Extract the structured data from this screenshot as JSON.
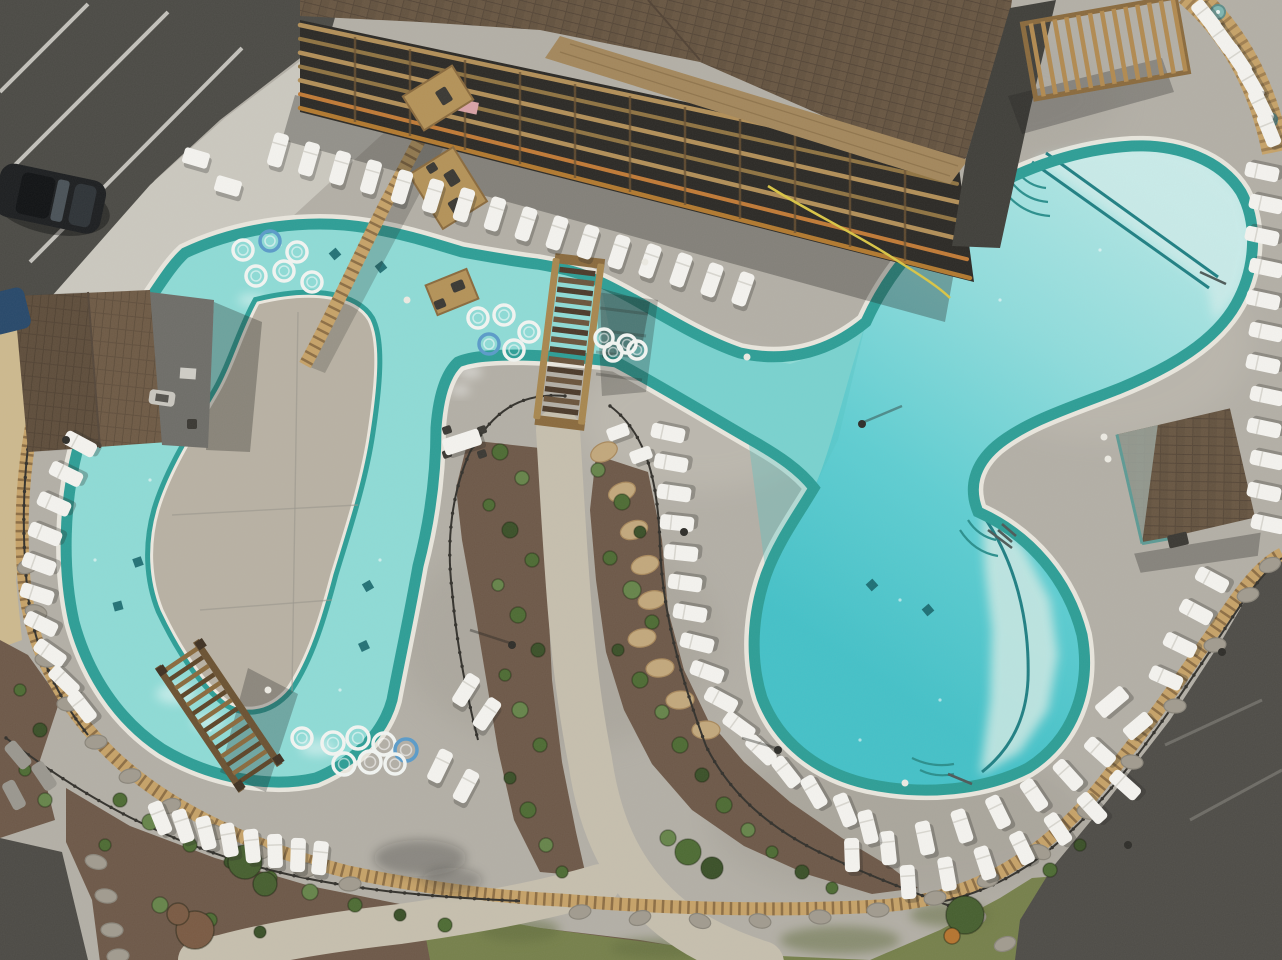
{
  "scene": {
    "label": "aerial drone photo of resort pool complex",
    "features": [
      "lazy river with concrete island",
      "large free-form swimming pool",
      "wooden footbridge",
      "wooden pergola trellis",
      "resort building with balconies",
      "pool house",
      "cabana",
      "white lounge chairs",
      "inner tubes",
      "landscaped beds with walking paths",
      "parking lots"
    ]
  },
  "palette": {
    "deck": "#b3afa6",
    "deck_light": "#c7c3ba",
    "deck_dark": "#a09c93",
    "island": "#b8b1a3",
    "sidewalk": "#cbc8bf",
    "asphalt": "#4b4a45",
    "asphalt_light": "#5a5953",
    "gravel": "#cdb98e",
    "mulch": "#6d5848",
    "mulch_dark": "#5c4a3c",
    "grass": "#76804b",
    "grass_dark": "#606c3d",
    "water_lazy": "#8edbd6",
    "water_rim": "#2d9e96",
    "coping": "#e9e6dd",
    "pool_shallow": "#cdecea",
    "pool_mid": "#7fd6d8",
    "pool_deep": "#46c2c9",
    "roof": "#63523f",
    "roof_light": "#75634e",
    "plywood": "#a3875c",
    "wood": "#b08a52",
    "wood_dark": "#7d5f36",
    "bridge_tread": "#4b3a2a",
    "fence": "#33312c",
    "lounger": "#f4f3ef",
    "lounger_shadow": "rgba(40,40,35,0.28)",
    "tan_band": "#c6a268",
    "tan_band_dark": "#7a5c38",
    "stone": "#a19b8f",
    "stone_dark": "#8a857a",
    "tan_stone": "#c2a87c",
    "shrub0": "#4d6b33",
    "shrub1": "#66844a",
    "shrub2": "#3a5028",
    "tree_green": "#465f2f",
    "tree_red": "#7a5a43",
    "tree_orange": "#b5742f",
    "hose": "#d9c545",
    "car": "#1c1e20",
    "vehicle_blue": "#27486a",
    "white_stripe": "#d8d6d0",
    "tube": "#f2f5f2",
    "tube_blue": "#5a9bc9"
  },
  "counts": {
    "loungers": 91,
    "gray_loungers": 3,
    "inner_tubes": 22,
    "tables": 7
  },
  "loungers": [
    [
      278,
      150,
      16
    ],
    [
      309,
      159,
      16
    ],
    [
      340,
      168,
      16
    ],
    [
      371,
      177,
      16
    ],
    [
      402,
      187,
      17
    ],
    [
      433,
      196,
      17
    ],
    [
      464,
      205,
      17
    ],
    [
      495,
      214,
      17
    ],
    [
      526,
      224,
      18
    ],
    [
      557,
      233,
      18
    ],
    [
      588,
      242,
      18
    ],
    [
      619,
      252,
      18
    ],
    [
      650,
      261,
      19
    ],
    [
      681,
      270,
      19
    ],
    [
      712,
      280,
      19
    ],
    [
      743,
      289,
      19
    ],
    [
      1206,
      16,
      -38
    ],
    [
      1222,
      38,
      -36
    ],
    [
      1238,
      60,
      -34
    ],
    [
      1251,
      83,
      -30
    ],
    [
      1261,
      106,
      -26
    ],
    [
      1269,
      130,
      -22
    ],
    [
      1262,
      172,
      -78
    ],
    [
      1266,
      204,
      -78
    ],
    [
      1262,
      236,
      -78
    ],
    [
      1266,
      268,
      -78
    ],
    [
      1263,
      300,
      -78
    ],
    [
      1266,
      332,
      -78
    ],
    [
      1263,
      364,
      -78
    ],
    [
      1267,
      396,
      -78
    ],
    [
      1264,
      428,
      -78
    ],
    [
      1267,
      460,
      -78
    ],
    [
      1264,
      492,
      -78
    ],
    [
      1268,
      524,
      -78
    ],
    [
      1212,
      580,
      -62
    ],
    [
      1196,
      612,
      -62
    ],
    [
      1180,
      645,
      -64
    ],
    [
      1166,
      678,
      -66
    ],
    [
      1100,
      752,
      -48
    ],
    [
      1068,
      775,
      -42
    ],
    [
      1034,
      795,
      -34
    ],
    [
      998,
      812,
      -26
    ],
    [
      962,
      826,
      -18
    ],
    [
      925,
      838,
      -12
    ],
    [
      888,
      848,
      -6
    ],
    [
      852,
      855,
      -2
    ],
    [
      1125,
      785,
      -48
    ],
    [
      1092,
      808,
      -42
    ],
    [
      1058,
      829,
      -34
    ],
    [
      1022,
      848,
      -26
    ],
    [
      985,
      863,
      -18
    ],
    [
      947,
      874,
      -10
    ],
    [
      908,
      882,
      -4
    ],
    [
      668,
      433,
      -78
    ],
    [
      671,
      463,
      -80
    ],
    [
      674,
      493,
      -82
    ],
    [
      677,
      523,
      -84
    ],
    [
      681,
      553,
      -84
    ],
    [
      685,
      583,
      -82
    ],
    [
      690,
      613,
      -80
    ],
    [
      697,
      643,
      -76
    ],
    [
      707,
      672,
      -70
    ],
    [
      721,
      700,
      -62
    ],
    [
      739,
      726,
      -54
    ],
    [
      761,
      750,
      -46
    ],
    [
      786,
      772,
      -38
    ],
    [
      814,
      792,
      -30
    ],
    [
      845,
      810,
      -22
    ],
    [
      868,
      827,
      -14
    ],
    [
      80,
      444,
      -62
    ],
    [
      66,
      474,
      -64
    ],
    [
      54,
      504,
      -66
    ],
    [
      45,
      534,
      -68
    ],
    [
      39,
      564,
      -70
    ],
    [
      37,
      594,
      -72
    ],
    [
      41,
      624,
      -64
    ],
    [
      50,
      653,
      -55
    ],
    [
      64,
      681,
      -46
    ],
    [
      82,
      707,
      -38
    ],
    [
      160,
      818,
      -22
    ],
    [
      183,
      826,
      -18
    ],
    [
      206,
      833,
      -14
    ],
    [
      229,
      840,
      -10
    ],
    [
      252,
      846,
      -6
    ],
    [
      275,
      851,
      -2
    ],
    [
      298,
      855,
      2
    ],
    [
      320,
      858,
      6
    ],
    [
      466,
      690,
      32
    ],
    [
      487,
      714,
      34
    ],
    [
      440,
      766,
      26
    ],
    [
      466,
      786,
      28
    ]
  ],
  "gray_loungers": [
    [
      18,
      755,
      -40
    ],
    [
      44,
      776,
      -34
    ],
    [
      14,
      795,
      -28
    ]
  ],
  "tables": [
    [
      196,
      158,
      26,
      16,
      16
    ],
    [
      228,
      186,
      26,
      16,
      16
    ],
    [
      462,
      442,
      38,
      17,
      -18
    ],
    [
      618,
      432,
      22,
      13,
      -20
    ],
    [
      641,
      455,
      22,
      13,
      -20
    ],
    [
      1112,
      702,
      34,
      16,
      -40
    ],
    [
      1138,
      726,
      30,
      15,
      -40
    ]
  ],
  "round_tables": [
    [
      1218,
      12
    ],
    [
      1270,
      120
    ]
  ],
  "wood_platforms": [
    [
      438,
      98,
      58,
      40,
      -32
    ],
    [
      448,
      188,
      52,
      64,
      -32
    ],
    [
      452,
      292,
      44,
      32,
      -22
    ]
  ],
  "dark_objects": [
    [
      444,
      96,
      12,
      16,
      -32
    ],
    [
      452,
      178,
      12,
      15,
      -32
    ],
    [
      456,
      206,
      12,
      14,
      -32
    ],
    [
      458,
      286,
      13,
      10,
      -22
    ],
    [
      440,
      304,
      11,
      9,
      -22
    ],
    [
      447,
      430,
      9,
      8,
      -18
    ],
    [
      447,
      454,
      9,
      8,
      -18
    ],
    [
      482,
      430,
      9,
      8,
      -18
    ],
    [
      482,
      454,
      9,
      8,
      -18
    ],
    [
      192,
      424,
      10,
      10,
      0
    ],
    [
      1178,
      540,
      20,
      13,
      -13
    ],
    [
      432,
      168,
      10,
      9,
      -32
    ]
  ],
  "light_objects": [
    [
      162,
      398,
      26,
      15,
      8
    ]
  ],
  "inner_tubes": [
    [
      243,
      250,
      10,
      "w"
    ],
    [
      270,
      241,
      10,
      "b"
    ],
    [
      297,
      252,
      10,
      "w"
    ],
    [
      256,
      276,
      10,
      "w"
    ],
    [
      284,
      271,
      10,
      "w"
    ],
    [
      312,
      282,
      10,
      "w"
    ],
    [
      478,
      318,
      10,
      "w"
    ],
    [
      504,
      315,
      10,
      "w"
    ],
    [
      529,
      332,
      10,
      "w"
    ],
    [
      489,
      344,
      10,
      "b"
    ],
    [
      514,
      350,
      10,
      "w"
    ],
    [
      604,
      338,
      9,
      "w"
    ],
    [
      627,
      344,
      9,
      "w"
    ],
    [
      613,
      352,
      9,
      "w"
    ],
    [
      637,
      350,
      9,
      "w"
    ],
    [
      333,
      743,
      11,
      "w"
    ],
    [
      358,
      738,
      11,
      "w"
    ],
    [
      384,
      744,
      11,
      "w"
    ],
    [
      406,
      750,
      11,
      "b"
    ],
    [
      344,
      764,
      11,
      "w"
    ],
    [
      370,
      762,
      11,
      "w"
    ],
    [
      395,
      764,
      10,
      "w"
    ],
    [
      302,
      738,
      10,
      "w"
    ]
  ],
  "drains": [
    [
      335,
      254,
      -40
    ],
    [
      381,
      267,
      -38
    ],
    [
      138,
      562,
      -20
    ],
    [
      118,
      606,
      -15
    ],
    [
      368,
      586,
      -30
    ],
    [
      364,
      646,
      -25
    ],
    [
      872,
      585,
      -42
    ],
    [
      928,
      610,
      -40
    ]
  ],
  "stones": [
    [
      28,
      566
    ],
    [
      36,
      612
    ],
    [
      46,
      660
    ],
    [
      68,
      704
    ],
    [
      96,
      742
    ],
    [
      130,
      776
    ],
    [
      170,
      806
    ],
    [
      214,
      832
    ],
    [
      258,
      852
    ],
    [
      305,
      870
    ],
    [
      350,
      884
    ],
    [
      580,
      912
    ],
    [
      640,
      918
    ],
    [
      700,
      921
    ],
    [
      760,
      921
    ],
    [
      820,
      917
    ],
    [
      878,
      910
    ],
    [
      935,
      898
    ],
    [
      988,
      880
    ],
    [
      1040,
      852
    ],
    [
      1088,
      812
    ],
    [
      1132,
      762
    ],
    [
      1175,
      706
    ],
    [
      1215,
      645
    ],
    [
      1248,
      595
    ],
    [
      1270,
      565
    ],
    [
      96,
      862
    ],
    [
      106,
      896
    ],
    [
      112,
      930
    ],
    [
      118,
      956
    ],
    [
      975,
      918
    ],
    [
      1005,
      944
    ]
  ],
  "tan_stones": [
    [
      604,
      452
    ],
    [
      622,
      492
    ],
    [
      634,
      530
    ],
    [
      645,
      565
    ],
    [
      652,
      600
    ],
    [
      642,
      638
    ],
    [
      660,
      668
    ],
    [
      680,
      700
    ],
    [
      706,
      730
    ]
  ],
  "shrubs": [
    [
      500,
      452,
      8,
      0
    ],
    [
      522,
      478,
      7,
      1
    ],
    [
      489,
      505,
      6,
      0
    ],
    [
      510,
      530,
      8,
      2
    ],
    [
      532,
      560,
      7,
      0
    ],
    [
      498,
      585,
      6,
      1
    ],
    [
      518,
      615,
      8,
      0
    ],
    [
      538,
      650,
      7,
      2
    ],
    [
      505,
      675,
      6,
      0
    ],
    [
      520,
      710,
      8,
      1
    ],
    [
      540,
      745,
      7,
      0
    ],
    [
      510,
      778,
      6,
      2
    ],
    [
      528,
      810,
      8,
      0
    ],
    [
      546,
      845,
      7,
      1
    ],
    [
      562,
      872,
      6,
      0
    ],
    [
      598,
      470,
      7,
      1
    ],
    [
      622,
      502,
      8,
      0
    ],
    [
      640,
      532,
      6,
      2
    ],
    [
      610,
      558,
      7,
      0
    ],
    [
      632,
      590,
      9,
      1
    ],
    [
      652,
      622,
      7,
      0
    ],
    [
      618,
      650,
      6,
      2
    ],
    [
      640,
      680,
      8,
      0
    ],
    [
      662,
      712,
      7,
      1
    ],
    [
      680,
      745,
      8,
      0
    ],
    [
      702,
      775,
      7,
      2
    ],
    [
      724,
      805,
      8,
      0
    ],
    [
      748,
      830,
      7,
      1
    ],
    [
      772,
      852,
      6,
      0
    ],
    [
      802,
      872,
      7,
      2
    ],
    [
      832,
      888,
      6,
      0
    ],
    [
      120,
      800,
      7,
      0
    ],
    [
      150,
      822,
      8,
      1
    ],
    [
      190,
      845,
      7,
      0
    ],
    [
      230,
      862,
      6,
      2
    ],
    [
      270,
      878,
      7,
      0
    ],
    [
      310,
      892,
      8,
      1
    ],
    [
      355,
      905,
      7,
      0
    ],
    [
      400,
      915,
      6,
      2
    ],
    [
      445,
      925,
      7,
      0
    ],
    [
      160,
      905,
      8,
      1
    ],
    [
      210,
      920,
      7,
      0
    ],
    [
      260,
      932,
      6,
      2
    ],
    [
      105,
      845,
      6,
      0
    ],
    [
      688,
      852,
      13,
      0
    ],
    [
      712,
      868,
      11,
      2
    ],
    [
      668,
      838,
      8,
      1
    ],
    [
      1050,
      870,
      7,
      0
    ],
    [
      1080,
      845,
      6,
      2
    ],
    [
      20,
      690,
      6,
      0
    ],
    [
      40,
      730,
      7,
      2
    ],
    [
      25,
      770,
      6,
      0
    ],
    [
      45,
      800,
      7,
      1
    ]
  ],
  "trees": [
    [
      245,
      862,
      17,
      "tree_green"
    ],
    [
      265,
      884,
      12,
      "tree_green"
    ],
    [
      195,
      930,
      19,
      "tree_red"
    ],
    [
      178,
      914,
      11,
      "tree_red"
    ],
    [
      965,
      915,
      19,
      "tree_green"
    ],
    [
      952,
      936,
      8,
      "tree_orange"
    ]
  ],
  "white_dots": [
    [
      407,
      300
    ],
    [
      747,
      357
    ],
    [
      1104,
      437
    ],
    [
      1108,
      459
    ],
    [
      645,
      262
    ],
    [
      905,
      783
    ],
    [
      268,
      690
    ]
  ],
  "dark_dots": [
    [
      684,
      532
    ],
    [
      1128,
      845
    ],
    [
      1222,
      652
    ],
    [
      512,
      645
    ],
    [
      862,
      424
    ],
    [
      66,
      440
    ],
    [
      778,
      750
    ]
  ],
  "sparkles": [
    [
      160,
      520
    ],
    [
      150,
      480
    ],
    [
      210,
      730
    ],
    [
      420,
      718
    ],
    [
      690,
      330
    ],
    [
      780,
      340
    ],
    [
      120,
      432
    ],
    [
      95,
      560
    ],
    [
      350,
      760
    ],
    [
      280,
      245
    ],
    [
      900,
      600
    ],
    [
      1000,
      300
    ],
    [
      1100,
      250
    ],
    [
      940,
      700
    ],
    [
      860,
      740
    ],
    [
      1060,
      520
    ],
    [
      380,
      560
    ],
    [
      340,
      690
    ]
  ],
  "foam": [
    [
      176,
      694,
      20,
      10
    ],
    [
      208,
      722,
      16,
      8
    ],
    [
      318,
      748,
      18,
      8
    ],
    [
      470,
      372,
      12,
      6
    ],
    [
      252,
      300,
      14,
      6
    ],
    [
      460,
      390,
      10,
      5
    ]
  ],
  "deck_patches": [
    [
      300,
      480,
      80,
      130,
      "#c3bcac",
      0.5
    ],
    [
      560,
      640,
      160,
      110,
      "#a29d93",
      0.4
    ],
    [
      700,
      420,
      120,
      70,
      "#c6c2b8",
      0.45
    ],
    [
      900,
      820,
      190,
      80,
      "#9b968c",
      0.35
    ],
    [
      1100,
      340,
      150,
      100,
      "#c2beb4",
      0.45
    ],
    [
      240,
      520,
      60,
      100,
      "#a8a399",
      0.35
    ],
    [
      1000,
      100,
      120,
      60,
      "#a8a49b",
      0.4
    ],
    [
      258,
      500,
      70,
      115,
      "#c6bfae",
      0.5
    ]
  ],
  "grass_blobs": [
    [
      520,
      930,
      40,
      12
    ],
    [
      660,
      948,
      50,
      10
    ],
    [
      840,
      940,
      60,
      14
    ],
    [
      950,
      915,
      40,
      12
    ]
  ],
  "parking_stripes": [
    [
      0,
      92,
      88,
      4
    ],
    [
      0,
      180,
      168,
      12
    ],
    [
      30,
      262,
      242,
      48
    ],
    [
      120,
      305,
      256,
      168
    ]
  ],
  "asphalt_stripes": [
    [
      1165,
      745,
      1262,
      700
    ],
    [
      1190,
      820,
      1282,
      770
    ]
  ],
  "joints": [
    [
      172,
      515,
      358,
      505
    ],
    [
      200,
      610,
      332,
      600
    ],
    [
      298,
      312,
      292,
      692
    ],
    [
      282,
      76,
      352,
      128
    ],
    [
      236,
      122,
      306,
      172
    ],
    [
      190,
      168,
      258,
      218
    ],
    [
      144,
      215,
      212,
      264
    ],
    [
      98,
      262,
      166,
      310
    ]
  ],
  "fence_post_paths": [
    "f1",
    "f2",
    "f3",
    "f4",
    "f5"
  ]
}
